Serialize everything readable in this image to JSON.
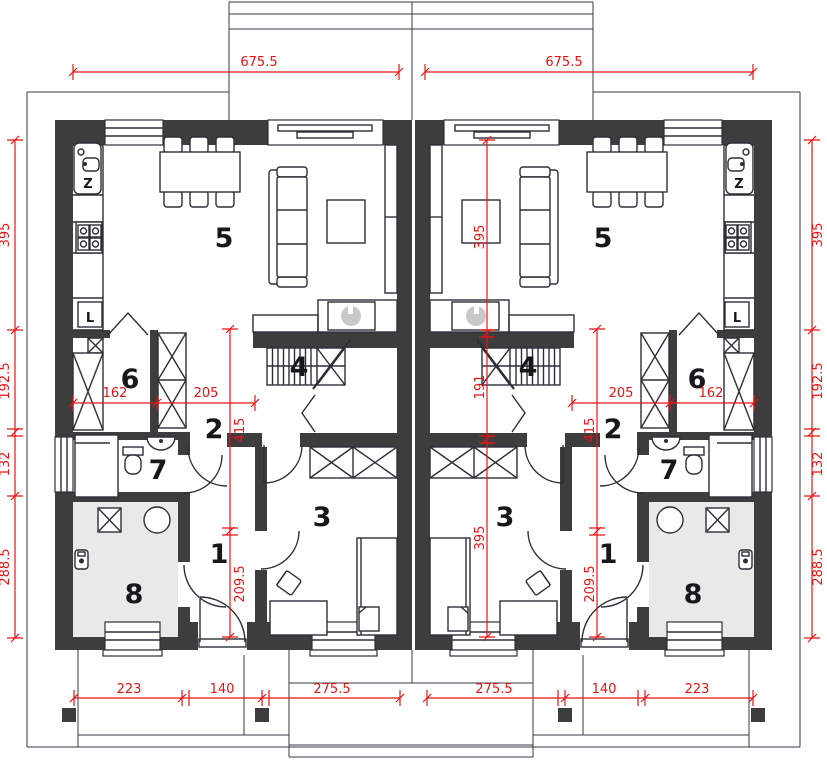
{
  "title": "duplex-ground-floor-plan",
  "colors": {
    "wall": "#3d3d3d",
    "dimension_red": "#e81414",
    "utility_floor_gray": "#e9e9e9",
    "appliance_gray": "#c9c9c9"
  },
  "dims": {
    "top_left": "675.5",
    "top_right": "675.5",
    "side": {
      "a": "395",
      "b": "192.5",
      "c": "132",
      "d": "288.5"
    },
    "left_unit": {
      "h1": "162",
      "h2": "205",
      "v1": "415",
      "v2": "209.5"
    },
    "right_unit": {
      "h1": "205",
      "h2": "162",
      "v1": "415",
      "v2": "209.5",
      "long1": "395",
      "long2": "191",
      "long3": "395"
    },
    "bottom_left": {
      "a": "223",
      "b": "140",
      "c": "275.5"
    },
    "bottom_right": {
      "a": "275.5",
      "b": "140",
      "c": "223"
    }
  },
  "rooms": {
    "r1": "1",
    "r2": "2",
    "r3": "3",
    "r4": "4",
    "r5": "5",
    "r6": "6",
    "r7": "7",
    "r8": "8"
  },
  "fixtures": {
    "sink": "Z",
    "fridge": "L"
  }
}
